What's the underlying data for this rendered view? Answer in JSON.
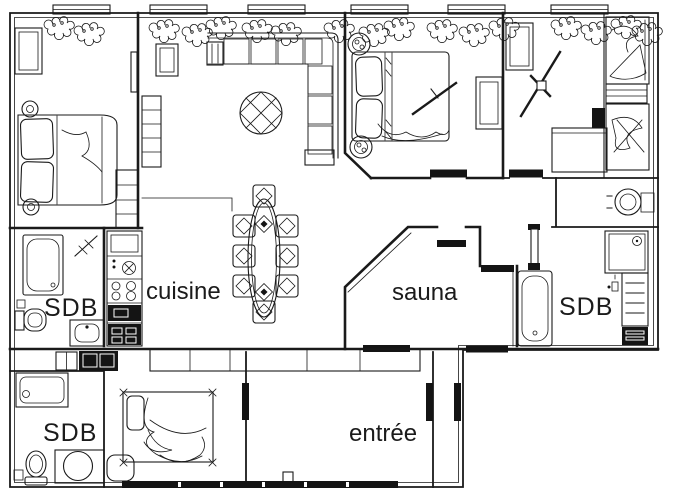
{
  "plan": {
    "type": "apartment-floor-plan",
    "colors": {
      "background": "#ffffff",
      "ink": "#1a1a1a"
    },
    "rooms": [
      {
        "id": "sdb-left",
        "label": "SDB"
      },
      {
        "id": "cuisine",
        "label": "cuisine"
      },
      {
        "id": "sauna",
        "label": "sauna"
      },
      {
        "id": "sdb-right",
        "label": "SDB"
      },
      {
        "id": "sdb-bottom",
        "label": "SDB"
      },
      {
        "id": "entree",
        "label": "entrée"
      }
    ]
  }
}
